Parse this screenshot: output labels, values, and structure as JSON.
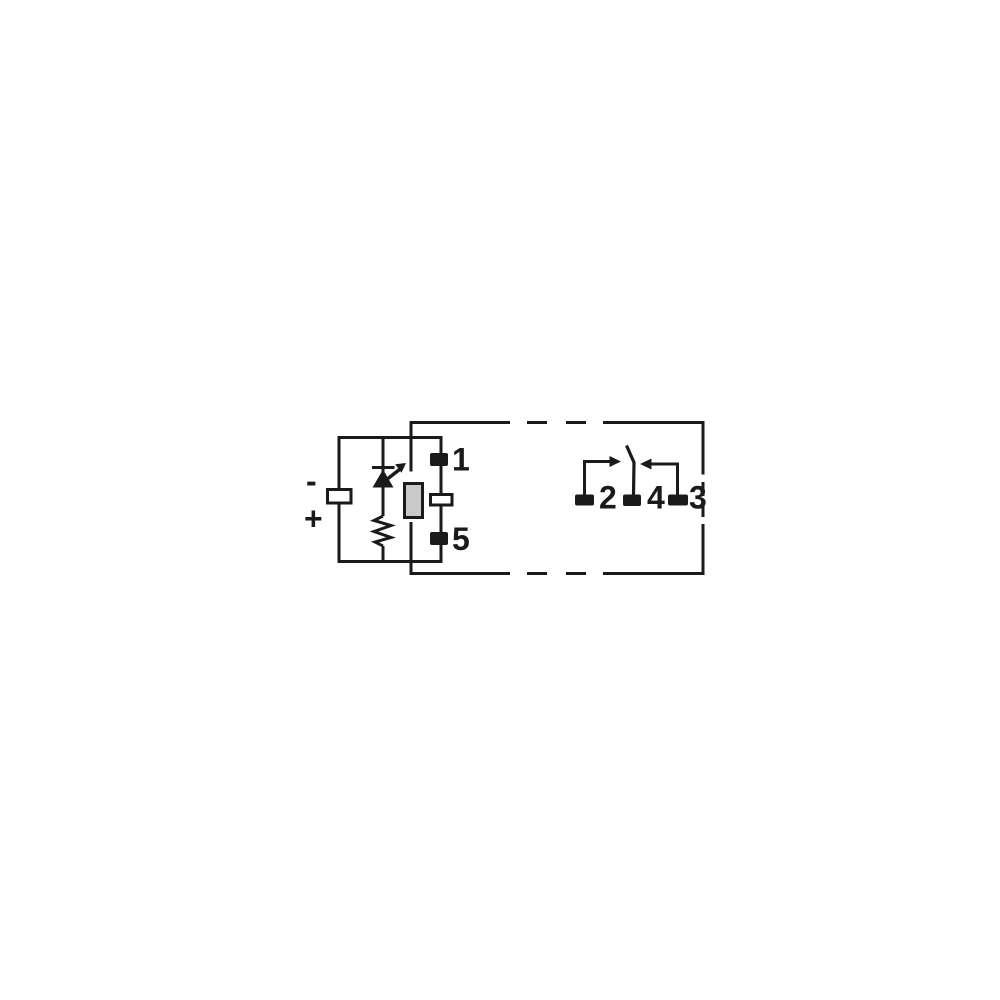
{
  "labels": {
    "polarity_minus": "-",
    "polarity_plus": "+",
    "pin1": "1",
    "pin5": "5",
    "pin2": "2",
    "pin4": "4",
    "pin3": "3"
  },
  "colors": {
    "line": "#1a1a1a",
    "coil_fill": "#c9c9c9",
    "background": "#ffffff"
  },
  "icons": {
    "led-icon": "diode-triangle-with-bar-and-emission-arrow",
    "resistor-icon": "zigzag",
    "relay-coil-icon": "gray-filled-rectangle-on-case-edge",
    "no-contact-arrow-icon": "right-pointing-filled-arrow",
    "nc-contact-arrow-icon": "left-pointing-filled-arrow",
    "switch-lever-icon": "slanted-contact-lever"
  }
}
